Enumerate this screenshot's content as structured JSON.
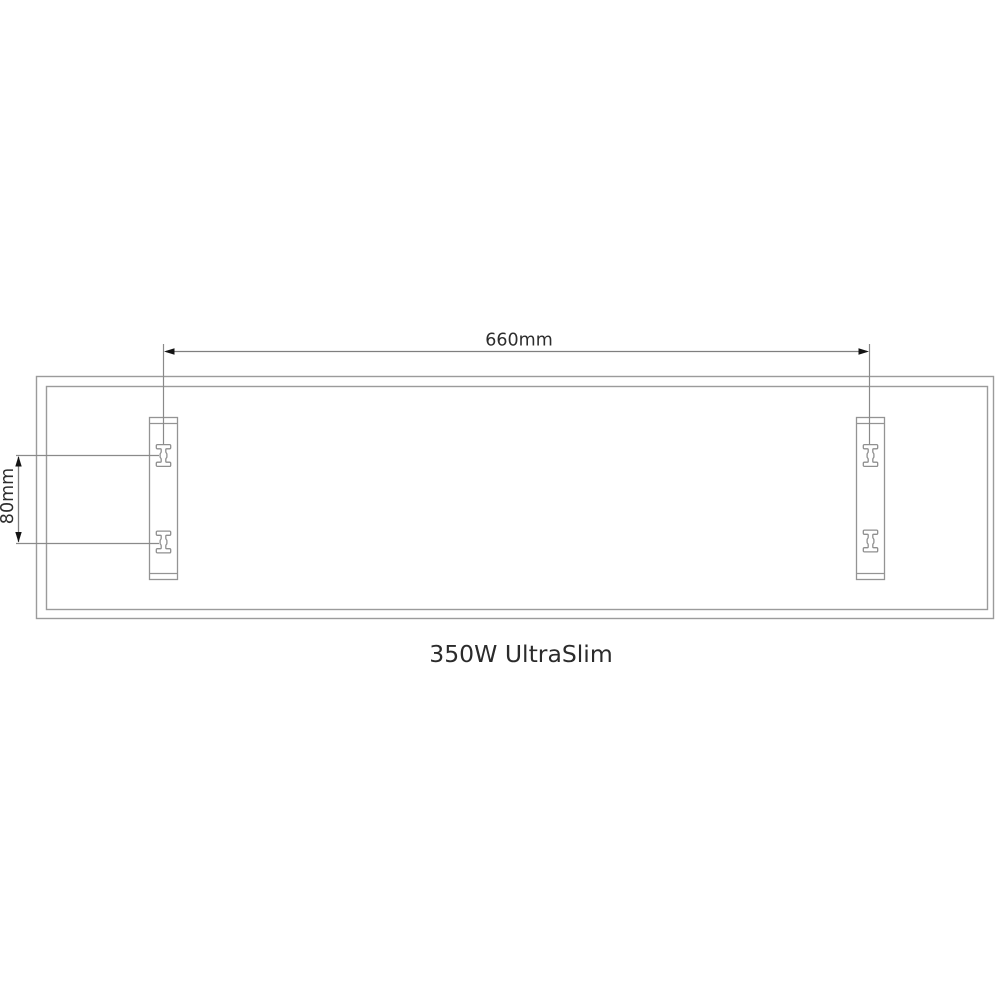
{
  "diagram": {
    "title": "350W UltraSlim",
    "dimensions": {
      "bracket_spacing_horizontal": "660mm",
      "slot_spacing_vertical": "80mm"
    },
    "colors": {
      "background": "#ffffff",
      "panel_outline": "#9b9b9b",
      "dimension_line": "#7f7f7f",
      "arrow": "#141414",
      "text": "#2d2d2d"
    }
  }
}
